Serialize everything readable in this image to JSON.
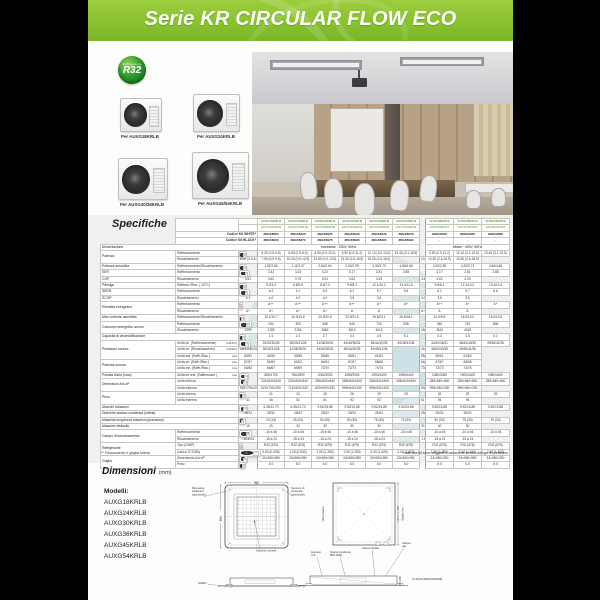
{
  "page": {
    "header_title": "Serie KR CIRCULAR FLOW ECO",
    "badge": {
      "line1": "Refrigerante",
      "line2": "R32"
    },
    "products": [
      {
        "caption": "Per AUXG18KRLB"
      },
      {
        "caption": "Per AUXG24KRLB"
      },
      {
        "caption": "Per AUXG30/36KRLB"
      },
      {
        "caption": "Per AUXG45/54KRLB"
      }
    ],
    "specs": {
      "title": "Specifiche",
      "header": {
        "modello_label": "Modello",
        "unit_int_label": "Unità int.",
        "unit_est_label": "Unità est.",
        "codice_white_label": "Codice Kit WHITE*",
        "codice_black_label": "Codice Kit BLACK*",
        "models_int": [
          "AUXG18KRLB",
          "AUXG24KRLB",
          "AUXG30KRLB",
          "AUXG36KRLB",
          "AUXG45KRLB",
          "AUXG54KRLB",
          "AUXG36KRLB",
          "AUXG45KRLB",
          "AUXG54KRLB"
        ],
        "models_est": [
          "AOYG18KBTB",
          "AOYG24KBTB",
          "AOYG30KBTB",
          "AOYG36KBTB",
          "AOYG45KBTB",
          "AOYG54KBTB",
          "AOYG36KATA",
          "AOYG45KATA",
          "AOYG54KATA"
        ],
        "codes_white": [
          "3NGF8860",
          "3NGF8920",
          "3NGF8925",
          "3NGF8930",
          "3NGF8935",
          "3NGF8940",
          "3NGF8945",
          "3NGF8950",
          "3NGF8955"
        ],
        "codes_black": [
          "3NGF8960",
          "3NGF8970",
          "3NGF8975",
          "3NGF8980",
          "3NGF8985",
          "3NGF8990",
          "-",
          "-",
          "-"
        ]
      },
      "alimentazione": {
        "label": "Alimentazione",
        "mono": "monofase ~230V, 50Hz",
        "tri": "trifase ~400V, 50Hz"
      },
      "rows": [
        {
          "g": "Potenza",
          "gs": 2,
          "l": "Raffrescamento",
          "u": "kW",
          "us": 2,
          "c": [
            "5.20 (0.9-5.6)",
            "6.80 (0.9-8.0)",
            "8.50 (0.9-10.2)",
            "9.50 (0.9-11.2)",
            "12.10 (3.0-13.0)",
            "13.40 (3.1-15.5)",
            "9.50 (0.9-11.2)",
            "12.10 (3.0-13.0)",
            "13.40 (3.1-15.5)"
          ]
        },
        {
          "l": "Riscaldamento",
          "c": [
            "6.00 (0.9-8.3)",
            "7.50 (0.9-9.5)",
            "10.00 (0.9-12.5)",
            "10.80 (0.9-13.5)",
            "13.50 (2.5-15.5)",
            "15.50 (2.6-18.0)",
            "10.80 (0.9-13.5)",
            "13.50 (2.5-15.5)",
            "15.50 (2.6-18.0)"
          ]
        },
        {
          "g": "Potenza assorbita",
          "l": "Raffrescamento/Riscaldamento",
          "u": "kW",
          "us": 1,
          "c": [
            "1.52/1.66",
            "2.11/2.07",
            "2.64/2.64",
            "3.00/2.99",
            "4.30/3.73",
            "4.66/4.66",
            "3.00/2.99",
            "4.30/3.73",
            "4.66/4.66"
          ]
        },
        {
          "g": "EER",
          "l": "Raffrescamento",
          "u": "W/W",
          "us": 2,
          "c": [
            "3.42",
            "3.23",
            "3.22",
            "3.17",
            "2.81",
            "2.88",
            "3.17",
            "2.81",
            "2.88"
          ]
        },
        {
          "g": "COP",
          "l": "Riscaldamento",
          "c": [
            "3.61",
            "3.62",
            "3.79",
            "3.61",
            "3.62",
            "3.33",
            "3.61",
            "3.62",
            "3.33"
          ]
        },
        {
          "g": "Pdesign",
          "l": "Raffresc./Risc. (-10°C)",
          "u": "kW",
          "us": 1,
          "c": [
            "5.2/4.3",
            "6.8/5.5",
            "8.5/7.0",
            "9.5/8.1",
            "12.1/10.2",
            "13.4/11.6",
            "9.5/8.1",
            "12.1/10.2",
            "13.4/11.6"
          ]
        },
        {
          "g": "SEER",
          "l": "Raffrescamento",
          "u": "W/W",
          "us": 2,
          "c": [
            "6.2",
            "6.1",
            "6.5",
            "6.1",
            "5.7",
            "5.6",
            "6.1",
            "5.7",
            "5.6"
          ]
        },
        {
          "g": "SCOP",
          "l": "Riscaldamento",
          "c": [
            "4.1",
            "4.0",
            "4.0",
            "4.0",
            "3.8",
            "3.8",
            "4.0",
            "3.8",
            "3.8"
          ]
        },
        {
          "g": "Etichetta energetica",
          "gs": 2,
          "l": "Raffrescamento",
          "u": "",
          "us": 2,
          "c": [
            "A++",
            "A++",
            "A++",
            "A++",
            "A+",
            "A+",
            "A++",
            "A+",
            "A+"
          ]
        },
        {
          "l": "Riscaldamento",
          "c": [
            "A+",
            "A+",
            "A+",
            "A+",
            "A",
            "A",
            "A+",
            "A",
            "A"
          ]
        },
        {
          "g": "Max corrente assorbita",
          "l": "Raffrescamento/Riscaldamento",
          "u": "A",
          "us": 1,
          "c": [
            "10.1/10.7",
            "10.9/10.8",
            "20.5/20.5",
            "22.5/21.5",
            "26.5/23.1",
            "26.5/28.1",
            "10.5/9.5",
            "15.0/13.0",
            "15.0/15.8"
          ]
        },
        {
          "g": "Consumo energetico annuo",
          "gs": 2,
          "l": "Raffrescamento",
          "u": "kWh/a",
          "us": 2,
          "c": [
            "294",
            "390",
            "458",
            "545",
            "743",
            "838",
            "545",
            "743",
            "838"
          ]
        },
        {
          "l": "Riscaldamento",
          "c": [
            "1399",
            "1785",
            "2194",
            "2684",
            "3610",
            "4015",
            "2684",
            "3610",
            "4015"
          ]
        },
        {
          "g": "Capacità di deumidificazione",
          "wide": true,
          "u": "l/h",
          "us": 1,
          "c": [
            "1.5",
            "2.1",
            "2.7",
            "3.3",
            "4.5",
            "5.1",
            "3.3",
            "4.5",
            "5.1"
          ]
        },
        {
          "g": "Pressione sonora",
          "gs": 3,
          "l": "Unità int. (Raffrescamento)",
          "t": "A/M/B/Q",
          "u": "dB(A)",
          "us": 5,
          "c": [
            "33/32/30/28",
            "35/33/31/28",
            "41/38/35/31",
            "44/40/36/31",
            "48/44/40/35",
            "49/45/41/36",
            "44/40/36/31",
            "48/44/40/35",
            "49/45/41/36"
          ]
        },
        {
          "l": "Unità int. (Riscaldamento)",
          "t": "A/M/B/Q",
          "c": [
            "33/32/30/28",
            "35/33/31/28",
            "41/38/35/31",
            "44/40/36/31",
            "48/44/40/35",
            "49/45/41/36",
            "44/40/36/31",
            "48/44/40/35",
            "49/45/41/36"
          ]
        },
        {
          "l": "Unità est. (Raffr./Risc.)",
          "t": "Alta",
          "c": [
            "50/52",
            "54/55",
            "53/58",
            "55/58",
            "59/61",
            "61/63",
            "55/58",
            "59/61",
            "61/63"
          ]
        },
        {
          "g": "Potenza sonora",
          "gs": 2,
          "l": "Unità int. (Raffr./Risc.)",
          "t": "Alta",
          "c": [
            "57/57",
            "60/60",
            "62/62",
            "64/64",
            "67/67",
            "68/68",
            "64/64",
            "67/67",
            "68/68"
          ]
        },
        {
          "l": "Unità est. (Raffr./Risc.)",
          "t": "Alta",
          "c": [
            "63/65",
            "66/67",
            "69/69",
            "70/70",
            "72/73",
            "74/75",
            "70/70",
            "72/73",
            "74/75"
          ]
        },
        {
          "g": "Portata d'aria (max)",
          "l": "Unità int./est. (Raffrescam.)",
          "t": "Alta",
          "u": "m³/h",
          "us": 1,
          "c": [
            "680/1700",
            "780/1890",
            "1050/3050",
            "1080/3050",
            "1900/4400",
            "1980/4400",
            "1080/3050",
            "1900/4400",
            "1980/4400"
          ]
        },
        {
          "g": "Dimensioni AxLxP",
          "gs": 2,
          "l": "Unità interna",
          "u": "mm",
          "us": 2,
          "c": [
            "245×840×840",
            "245×840×840",
            "288×840×840",
            "288×840×840",
            "288×840×840",
            "288×840×840",
            "288×840×840",
            "288×840×840",
            "288×840×840"
          ]
        },
        {
          "l": "Unità esterna",
          "c": [
            "542×790×290",
            "620×790×290",
            "716×900×330",
            "830×900×330",
            "998×940×330",
            "998×940×330",
            "830×900×330",
            "998×940×330",
            "998×940×330"
          ]
        },
        {
          "g": "Peso",
          "gs": 2,
          "l": "Unità interna",
          "u": "kg",
          "us": 2,
          "c": [
            "21",
            "24",
            "26",
            "26",
            "29",
            "29",
            "26",
            "29",
            "29"
          ]
        },
        {
          "l": "Unità esterna",
          "c": [
            "41",
            "45",
            "52",
            "61",
            "92",
            "92",
            "61",
            "94",
            "94"
          ]
        },
        {
          "g": "Attacchi tubazioni",
          "wide": true,
          "u": "mm",
          "us": 2,
          "c": [
            "6.35/12.70",
            "6.35/12.70",
            "9.52/15.88",
            "9.52/15.88",
            "9.52/15.88",
            "9.52/15.88",
            "9.52/15.88",
            "9.52/15.88",
            "9.52/15.88"
          ]
        },
        {
          "g": "Diametro scarico condensa (int/est)",
          "wide": true,
          "c": [
            "25/32",
            "25/32",
            "25/32",
            "25/32",
            "25/32",
            "25/32",
            "25/32",
            "25/32",
            "25/32"
          ]
        },
        {
          "g": "Massima lunghezza tubazioni (precarica)",
          "wide": true,
          "u": "m",
          "us": 2,
          "c": [
            "20 (15)",
            "25 (20)",
            "50 (30)",
            "50 (30)",
            "75 (30)",
            "75 (30)",
            "50 (30)",
            "75 (30)",
            "75 (30)"
          ]
        },
        {
          "g": "Massimo dislivello",
          "wide": true,
          "c": [
            "15",
            "20",
            "30",
            "30",
            "30",
            "30",
            "30",
            "30",
            "30"
          ]
        },
        {
          "g": "Campo di funzionamento",
          "gs": 2,
          "l": "Raffrescamento",
          "u": "°C DB",
          "us": 2,
          "c": [
            "-10 a 46",
            "-10 a 46",
            "-10 a 46",
            "-10 a 46",
            "-10 a 46",
            "-10 a 46",
            "-10 a 46",
            "-10 a 46",
            "-10 a 46"
          ]
        },
        {
          "l": "Riscaldamento",
          "c": [
            "-15 a 24",
            "-15 a 24",
            "-15 a 24",
            "-15 a 24",
            "-15 a 24",
            "-15 a 24",
            "-15 a 24",
            "-15 a 24",
            "-15 a 24"
          ]
        },
        {
          "g": "Refrigerante",
          "gs": 2,
          "l": "Tipo (GWP)",
          "u": "",
          "us": 1,
          "c": [
            "R32 (675)",
            "R32 (675)",
            "R32 (675)",
            "R32 (675)",
            "R32 (675)",
            "R32 (675)",
            "R32 (675)",
            "R32 (675)",
            "R32 (675)"
          ]
        },
        {
          "l": "Carica TCO2Eq",
          "u": "kg(CO2eq.T)",
          "us": 1,
          "c": [
            "0.60 (0.405)",
            "1.25 (0.844)",
            "1.90 (1.283)",
            "1.90 (1.283)",
            "2.40 (1.620)",
            "2.40 (1.620)",
            "1.90 (1.283)",
            "2.40 (1.620)",
            "2.40 (1.620)"
          ]
        },
        {
          "g": "Griglia",
          "gs": 2,
          "l": "Dimensione AxLxP",
          "u": "mm",
          "us": 1,
          "c": [
            "33×950×950",
            "33×950×950",
            "33×950×950",
            "33×950×950",
            "33×950×950",
            "33×950×950",
            "33×950×950",
            "33×950×950",
            "33×950×950"
          ]
        },
        {
          "l": "Peso",
          "u": "kg",
          "us": 1,
          "c": [
            "5.0",
            "5.0",
            "6.0",
            "6.0",
            "6.0",
            "6.0",
            "6.0",
            "6.0",
            "6.0"
          ]
        }
      ],
      "footnote_left": "** Filocomando e griglia inclusi",
      "footnote_right": "I dati tecnici sono soggetti a variazione senza obbligo di preavviso"
    },
    "dimensions": {
      "title": "Dimensioni",
      "unit": "(mm)",
      "models_label": "Modelli:",
      "models": [
        "AUXG18KRLB",
        "AUXG24KRLB",
        "AUXG30KRLB",
        "AUXG36KRLB",
        "AUXG45KRLB",
        "AUXG54KRLB"
      ],
      "labels": {
        "ricevente": [
          "Ricevente",
          "infrarossi",
          "(opzionale)"
        ],
        "sensore": [
          "Sensore di",
          "presenza",
          "(opzionale)"
        ],
        "dim950_top": "950",
        "dim950_left": "950",
        "accesso": "Accesso schede",
        "soffitto": "Soffitto",
        "unita_interna": "Unità interna",
        "foro1": "□860 fra 950",
        "foro2": "Quadro foro",
        "ingresso": [
          "Ingresso",
          "cavi"
        ],
        "scarico": [
          "Scarico condensa",
          "Ø25 (Ø32)"
        ],
        "att_liquido": "Attacco liquido",
        "att_gas": [
          "Attacco",
          "gas"
        ],
        "dim_lato": "295 (298)",
        "nota": "① AUXG18/22/24KRLB"
      }
    }
  }
}
